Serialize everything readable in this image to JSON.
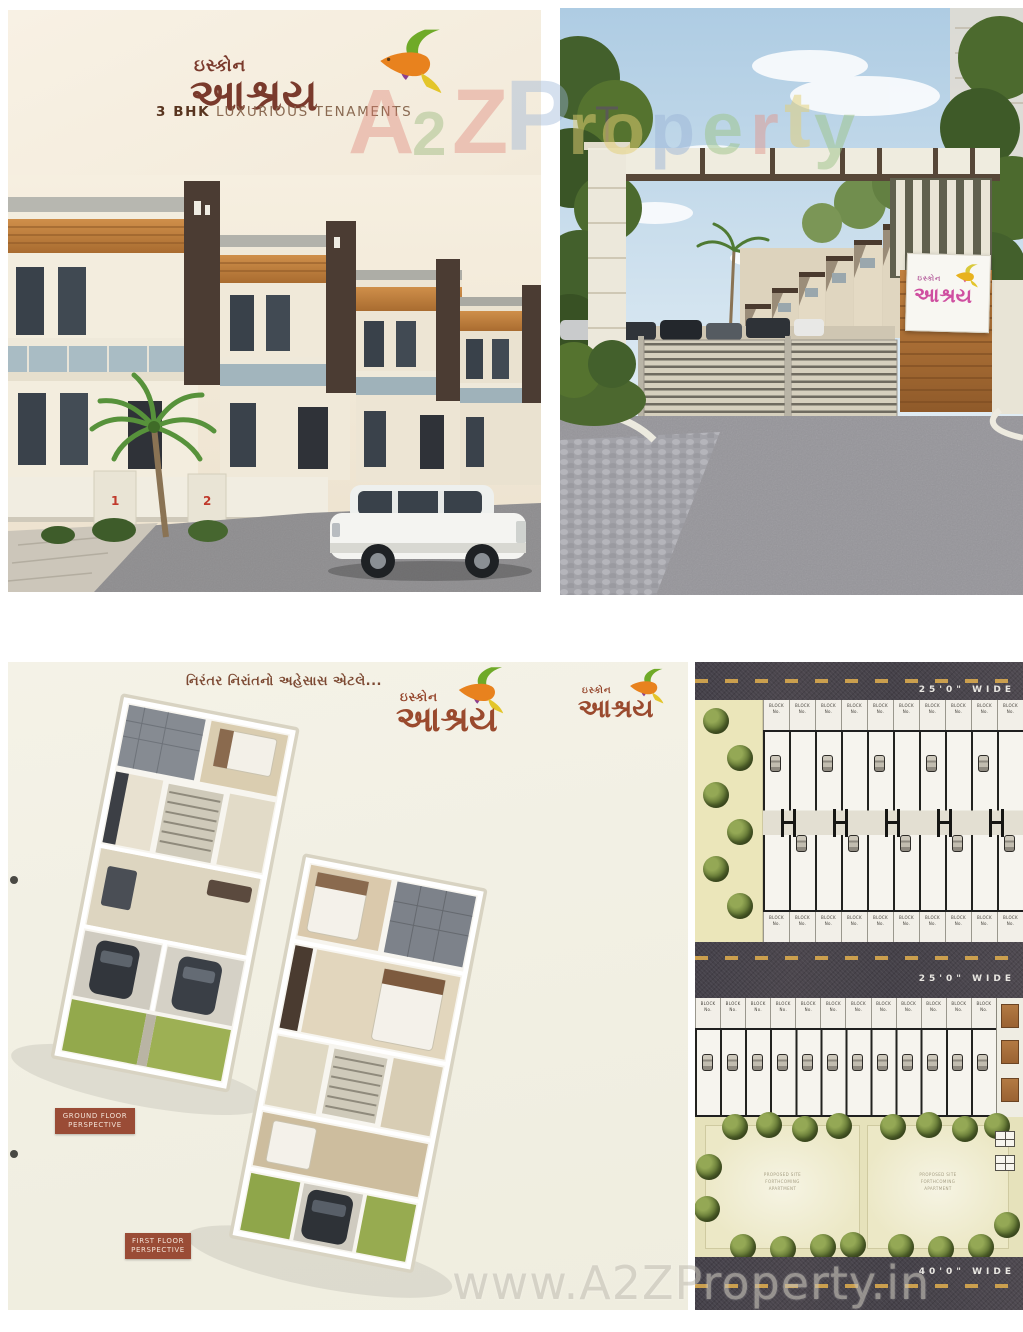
{
  "brand": {
    "logo_top": "ઇસ્કોન",
    "logo_main": "આશ્રય",
    "tagline_bold": "3 BHK",
    "tagline_rest": " LUXURIOUS TENAMENTS"
  },
  "watermark": {
    "bottom_text": "www.A2ZProperty.in",
    "top_letters": [
      {
        "ch": "A",
        "x": 348,
        "y": 76,
        "s": 92,
        "c": "#dd7b6e",
        "o": 0.36
      },
      {
        "ch": "2",
        "x": 412,
        "y": 104,
        "s": 62,
        "c": "#85ae68",
        "o": 0.36
      },
      {
        "ch": "Z",
        "x": 452,
        "y": 76,
        "s": 92,
        "c": "#dd7b6e",
        "o": 0.36
      },
      {
        "ch": "P",
        "x": 505,
        "y": 66,
        "s": 100,
        "c": "#9db6d8",
        "o": 0.42
      },
      {
        "ch": "r",
        "x": 568,
        "y": 92,
        "s": 74,
        "c": "#e4cf74",
        "o": 0.5
      },
      {
        "ch": "o",
        "x": 600,
        "y": 92,
        "s": 74,
        "c": "#e4cf74",
        "o": 0.5
      },
      {
        "ch": "p",
        "x": 650,
        "y": 92,
        "s": 74,
        "c": "#9db6d8",
        "o": 0.5
      },
      {
        "ch": "e",
        "x": 702,
        "y": 92,
        "s": 74,
        "c": "#9cc488",
        "o": 0.5
      },
      {
        "ch": "r",
        "x": 750,
        "y": 92,
        "s": 74,
        "c": "#e09a90",
        "o": 0.5
      },
      {
        "ch": "t",
        "x": 784,
        "y": 80,
        "s": 80,
        "c": "#e4cf74",
        "o": 0.5
      },
      {
        "ch": "y",
        "x": 814,
        "y": 92,
        "s": 74,
        "c": "#9cc488",
        "o": 0.5
      }
    ]
  },
  "cover": {
    "house_numbers": [
      "1",
      "2"
    ]
  },
  "floorplans": {
    "tagline": "નિરંતર નિરાંતનો અહેસાસ એટલે...",
    "ground_label": [
      "GROUND FLOOR",
      "PERSPECTIVE"
    ],
    "first_label": [
      "FIRST FLOOR",
      "PERSPECTIVE"
    ]
  },
  "siteplan": {
    "road_top": "25'0\" WIDE",
    "road_mid": "25'0\" WIDE",
    "road_bottom": "40'0\" WIDE",
    "block_line1": "BLOCK",
    "block_line2": "No.",
    "row1_top_count": 10,
    "row1_bottom_count": 10,
    "row2_count": 12,
    "garden_left": [
      "PROPOSED SITE",
      "FORTHCOMING",
      "APARTMENT"
    ],
    "garden_right": [
      "PROPOSED SITE",
      "FORTHCOMING",
      "APARTMENT"
    ]
  }
}
